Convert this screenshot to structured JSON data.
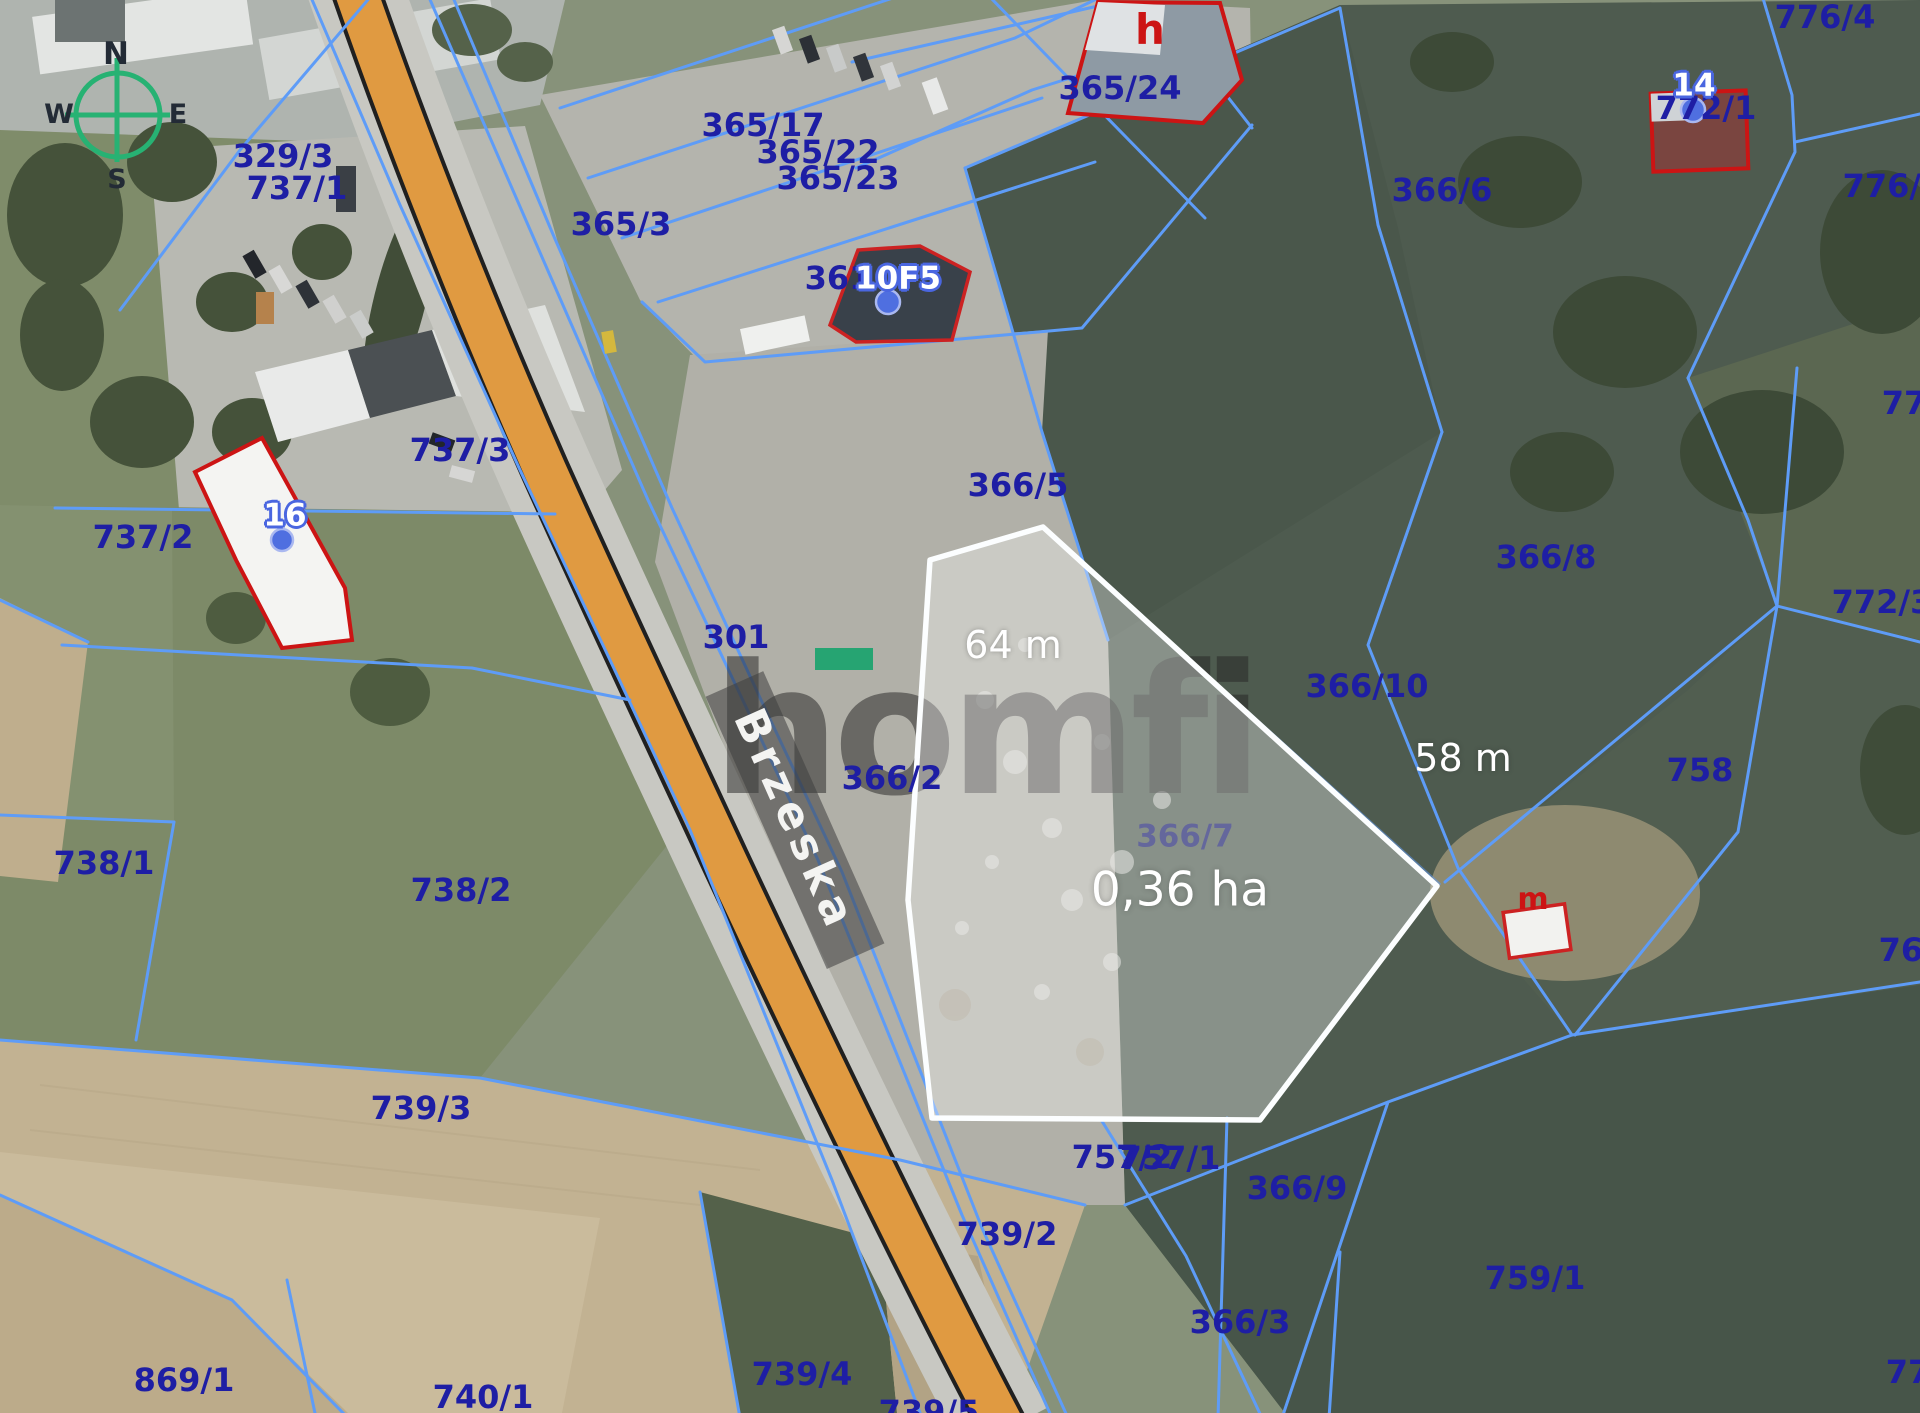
{
  "map": {
    "watermark_text": "homfi",
    "road_name": "Brzeska",
    "compass": {
      "n": "N",
      "e": "E",
      "s": "S",
      "w": "W"
    },
    "highlight": {
      "parcel_label": "366/7",
      "area_label": "0,36 ha",
      "edge_labels": {
        "top": "64 m",
        "right": "58 m"
      }
    },
    "address_markers": [
      {
        "label": "16"
      },
      {
        "label": "10F5"
      },
      {
        "label": "14"
      }
    ],
    "building_letters": [
      {
        "text": "h"
      },
      {
        "text": "m"
      }
    ],
    "parcel_labels": [
      "329/3",
      "737/1",
      "365/3",
      "365/17",
      "365/22",
      "365/23",
      "365/24",
      "366/6",
      "776/4",
      "776/5",
      "77",
      "772/3",
      "758",
      "772/1",
      "361",
      "366/5",
      "737/3",
      "737/2",
      "366/10",
      "366/8",
      "301",
      "366/2",
      "738/1",
      "738/2",
      "739/3",
      "739/2",
      "757/2",
      "757/1",
      "366/9",
      "869/1",
      "740/1",
      "739/4",
      "739/5",
      "366/3",
      "759/1",
      "760",
      "77"
    ]
  },
  "colors": {
    "parcel_label": "#1e1ea4",
    "boundary_line": "#5e9cf7",
    "road_fill": "#e09a41",
    "highlight_outline": "#ffffff",
    "building_outline": "#cc1414",
    "watermark_accent": "#17a36c"
  }
}
